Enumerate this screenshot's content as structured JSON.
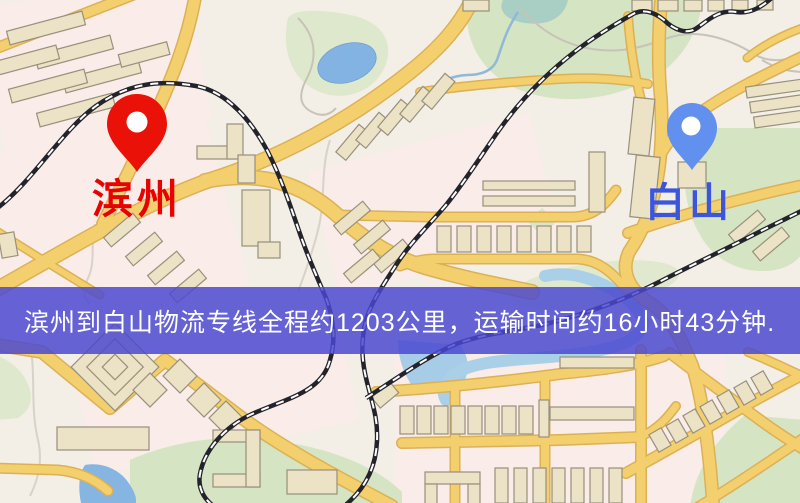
{
  "map": {
    "type": "logistics-route-map",
    "markers": [
      {
        "id": "binzhou",
        "label": "滨州",
        "label_color": "#e60300",
        "pin_color": "#ea1208"
      },
      {
        "id": "baishan",
        "label": "白山",
        "label_color": "#3c55dd",
        "pin_color": "#6190ee"
      }
    ],
    "banner": {
      "text": "滨州到白山物流专线全程约1203公里，运输时间约16小时43分钟.",
      "background_color": "#4a48d0",
      "background_opacity": 0.84,
      "text_color": "#ffffff"
    },
    "route": {
      "from": "滨州",
      "to": "白山",
      "distance_km": "1203",
      "duration": "16小时43分钟"
    },
    "palette": {
      "land": "#f3eee6",
      "residential": "#f9ece9",
      "park": "#d5e4c2",
      "water": "#86b5e2",
      "stream": "#a9cfc4",
      "road": "#f4cf6e",
      "road_casing": "#dcb156",
      "building": "#ece2c6",
      "railway": "#23232b"
    }
  }
}
